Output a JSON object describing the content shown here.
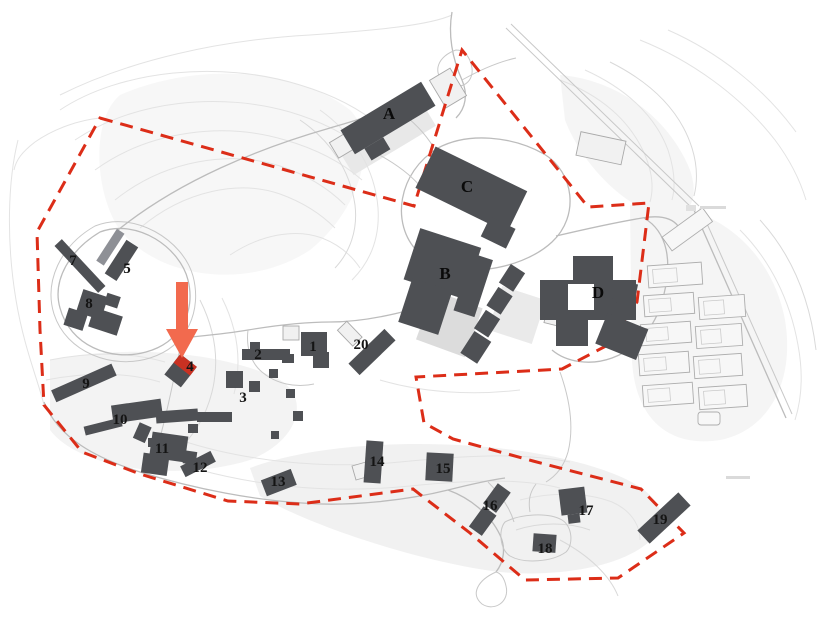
{
  "page": {
    "type": "architectural-site-plan",
    "background": "#ffffff"
  },
  "colors": {
    "building": "#4e5054",
    "building_light": "#8e9096",
    "boundary": "#dc2d18",
    "arrow": "#f26a4e",
    "highlight": "#c93122",
    "road": "#bcbcbc",
    "contour": "#e3e3e3"
  },
  "labels": {
    "n1": "1",
    "n2": "2",
    "n3": "3",
    "n4": "4",
    "n5": "5",
    "n7": "7",
    "n8": "8",
    "n9": "9",
    "n10": "10",
    "n11": "11",
    "n12": "12",
    "n13": "13",
    "n14": "14",
    "n15": "15",
    "n16": "16",
    "n17": "17",
    "n18": "18",
    "n19": "19",
    "n20": "20",
    "A": "A",
    "B": "B",
    "C": "C",
    "D": "D"
  },
  "arrow": {
    "target_building": "4"
  }
}
